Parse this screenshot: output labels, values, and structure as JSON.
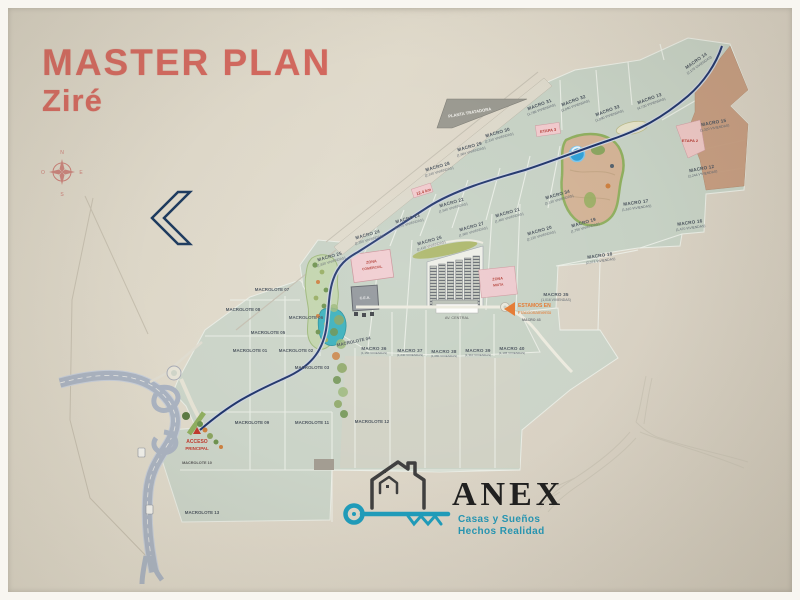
{
  "title": {
    "line1": "MASTER PLAN",
    "line2": "Ziré"
  },
  "compass": {
    "n": "N",
    "s": "S",
    "e": "E",
    "o": "O"
  },
  "map": {
    "plant_label": "PLANTA TRATADORA",
    "km_note": "12.4 km",
    "etapa2": "ETAPA 2",
    "etapa3": "ETAPA 3",
    "central_avenue": "AV. CENTRAL",
    "cea_label": "C.E.A.",
    "zona_comercial": {
      "line1": "ZONA",
      "line2": "COMERCIAL"
    },
    "zona_mixta": {
      "line1": "ZONA",
      "line2": "MIXTA"
    },
    "here_marker": {
      "line1": "ESTAMOS EN",
      "line2": "Fraccionamiento",
      "sub": "MACRO 43"
    },
    "entrance_marker": {
      "line1": "ACCESO",
      "line2": "PRINCIPAL",
      "sub": "MACROLOTE 10"
    },
    "parcels": [
      {
        "label": "MACRO 24",
        "sub": "(2,350 VIVIENDAS)"
      },
      {
        "label": "MACRO 25",
        "sub": "(1,820 VIVIENDAS)"
      },
      {
        "label": "MACRO 23",
        "sub": "(2,070 VIVIENDAS)"
      },
      {
        "label": "MACRO 22",
        "sub": "(1,540 VIVIENDAS)"
      },
      {
        "label": "MACRO 26",
        "sub": "(2,410 VIVIENDAS)"
      },
      {
        "label": "MACRO 27",
        "sub": "(1,980 VIVIENDAS)"
      },
      {
        "label": "MACRO 21",
        "sub": "(1,460 VIVIENDAS)"
      },
      {
        "label": "MACRO 20",
        "sub": "(2,120 VIVIENDAS)"
      },
      {
        "label": "MACRO 19",
        "sub": "(1,750 VIVIENDAS)"
      },
      {
        "label": "MACRO 31",
        "sub": "(1,786 VIVIENDAS)"
      },
      {
        "label": "MACRO 32",
        "sub": "(2,040 VIVIENDAS)"
      },
      {
        "label": "MACRO 33",
        "sub": "(1,890 VIVIENDAS)"
      },
      {
        "label": "MACRO 13",
        "sub": "(4,730 VIVIENDAS)"
      },
      {
        "label": "MACRO 14",
        "sub": "(2,170 VIVIENDAS)"
      },
      {
        "label": "MACRO 15",
        "sub": "(1,320 VIVIENDAS)"
      },
      {
        "label": "MACRO 12",
        "sub": "(2,244 VIVIENDAS)"
      },
      {
        "label": "MACRO 17",
        "sub": "(1,610 VIVIENDAS)"
      },
      {
        "label": "MACRO 16",
        "sub": "(1,470 VIVIENDAS)"
      },
      {
        "label": "MACRO 18",
        "sub": "(2,073 VIVIENDAS)"
      },
      {
        "label": "MACRO 29",
        "sub": "(1,984 VIVIENDAS)"
      },
      {
        "label": "MACRO 28",
        "sub": "(2,140 VIVIENDAS)"
      },
      {
        "label": "MACRO 34",
        "sub": "(3,120 VIVIENDAS)"
      },
      {
        "label": "MACRO 36",
        "sub": "(1,150 VIVIENDAS)"
      },
      {
        "label": "MACRO 37",
        "sub": "(1,240 VIVIENDAS)"
      },
      {
        "label": "MACRO 38",
        "sub": "(1,080 VIVIENDAS)"
      },
      {
        "label": "MACRO 39",
        "sub": "(1,310 VIVIENDAS)"
      },
      {
        "label": "MACRO 40",
        "sub": "(1,195 VIVIENDAS)"
      },
      {
        "label": "MACRO 35",
        "sub": "(1,016 VIVIENDAS)"
      },
      {
        "label": "MACRO 30",
        "sub": "(2,310 VIVIENDAS)"
      }
    ],
    "macrolotes": [
      {
        "label": "MACROLOTE 07"
      },
      {
        "label": "MACROLOTE 08"
      },
      {
        "label": "MACROLOTE 06"
      },
      {
        "label": "MACROLOTE 05"
      },
      {
        "label": "MACROLOTE 01"
      },
      {
        "label": "MACROLOTE 02"
      },
      {
        "label": "MACROLOTE 03"
      },
      {
        "label": "MACROLOTE 04"
      },
      {
        "label": "MACROLOTE 09"
      },
      {
        "label": "MACROLOTE 11"
      },
      {
        "label": "MACROLOTE 12"
      },
      {
        "label": "MACROLOTE 13"
      }
    ]
  },
  "brand": {
    "name": "ANEX",
    "tagline1": "Casas y Sueños",
    "tagline2": "Hechos Realidad"
  },
  "colors": {
    "title_accent": "#d2685e",
    "road_blue": "#20356b",
    "brand_teal": "#2496b4",
    "parcel_green": "#c8d3c6",
    "highway_gray": "#aab3c1",
    "pink_zone": "#f0cbcf",
    "tan_zone": "#c59a7d",
    "lake_teal": "#3ab0bc",
    "pond_blue": "#2f9fd6"
  }
}
